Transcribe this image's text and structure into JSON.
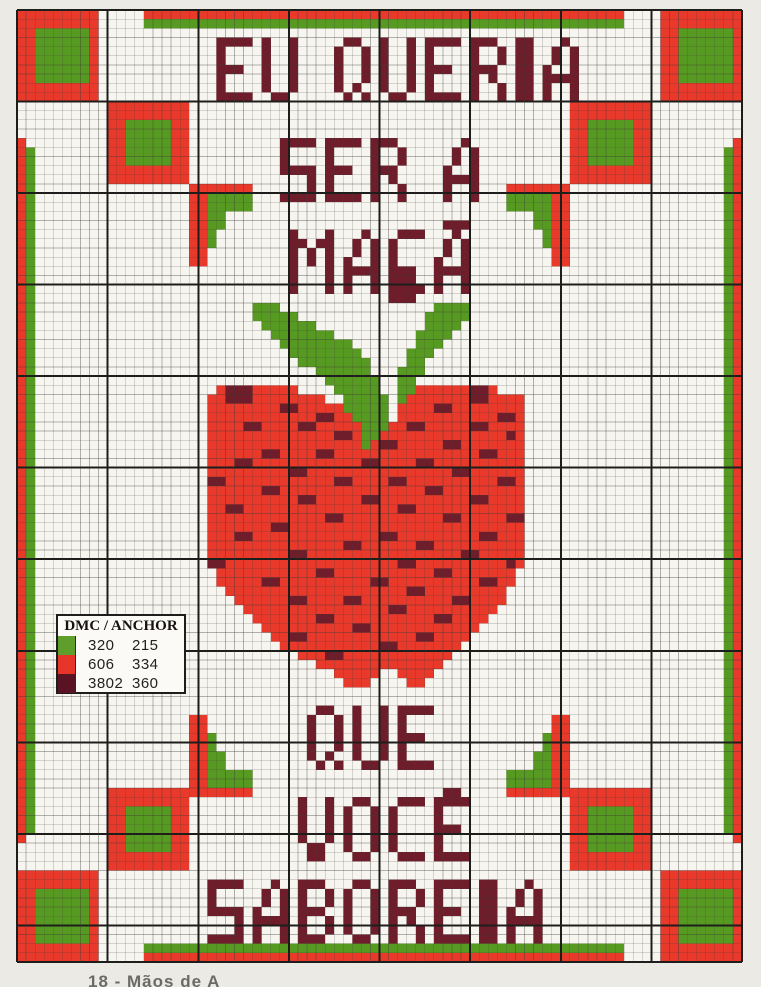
{
  "title": "Cross-stitch chart",
  "caption": {
    "text": "18 - Mãos de A"
  },
  "colors": {
    "red": "#e8392b",
    "green": "#579a21",
    "dark": "#701d2b",
    "chip_green": "#5f9e2a",
    "chip_red": "#e73529",
    "chip_dark": "#5a1322",
    "paper": "#f7f5f0",
    "page_bg": "#eceae4",
    "grid_thin": "#3a3a38",
    "grid_thick": "#1d1d1b"
  },
  "grid": {
    "cols": 80,
    "rows": 104,
    "origin_x": 17,
    "origin_y": 10,
    "width_px": 725,
    "height_px": 952
  },
  "border": {
    "rects": [
      {
        "c": 0,
        "r": 0,
        "w": 9,
        "h": 10,
        "k": "red"
      },
      {
        "c": 2,
        "r": 2,
        "w": 6,
        "h": 6,
        "k": "green"
      },
      {
        "c": 71,
        "r": 0,
        "w": 9,
        "h": 10,
        "k": "red"
      },
      {
        "c": 73,
        "r": 2,
        "w": 6,
        "h": 6,
        "k": "green"
      },
      {
        "c": 14,
        "r": 0,
        "w": 53,
        "h": 1,
        "k": "red"
      },
      {
        "c": 14,
        "r": 1,
        "w": 53,
        "h": 1,
        "k": "green"
      },
      {
        "c": 10,
        "r": 10,
        "w": 9,
        "h": 9,
        "k": "red"
      },
      {
        "c": 12,
        "r": 12,
        "w": 5,
        "h": 5,
        "k": "green"
      },
      {
        "c": 61,
        "r": 10,
        "w": 9,
        "h": 9,
        "k": "red"
      },
      {
        "c": 63,
        "r": 12,
        "w": 5,
        "h": 5,
        "k": "green"
      },
      {
        "c": 0,
        "r": 14,
        "w": 1,
        "h": 77,
        "k": "red"
      },
      {
        "c": 1,
        "r": 15,
        "w": 1,
        "h": 75,
        "k": "green"
      },
      {
        "c": 79,
        "r": 14,
        "w": 1,
        "h": 77,
        "k": "red"
      },
      {
        "c": 78,
        "r": 15,
        "w": 1,
        "h": 75,
        "k": "green"
      },
      {
        "c": 10,
        "r": 85,
        "w": 9,
        "h": 9,
        "k": "red"
      },
      {
        "c": 12,
        "r": 87,
        "w": 5,
        "h": 5,
        "k": "green"
      },
      {
        "c": 61,
        "r": 85,
        "w": 9,
        "h": 9,
        "k": "red"
      },
      {
        "c": 63,
        "r": 87,
        "w": 5,
        "h": 5,
        "k": "green"
      },
      {
        "c": 0,
        "r": 94,
        "w": 9,
        "h": 10,
        "k": "red"
      },
      {
        "c": 2,
        "r": 96,
        "w": 6,
        "h": 6,
        "k": "green"
      },
      {
        "c": 71,
        "r": 94,
        "w": 9,
        "h": 10,
        "k": "red"
      },
      {
        "c": 73,
        "r": 96,
        "w": 6,
        "h": 6,
        "k": "green"
      },
      {
        "c": 14,
        "r": 102,
        "w": 53,
        "h": 1,
        "k": "green"
      },
      {
        "c": 14,
        "r": 103,
        "w": 53,
        "h": 1,
        "k": "red"
      }
    ]
  },
  "bracket_motif": {
    "pattern": [
      ".....RR",
      ".....RR",
      "....GRR",
      "....GRR",
      "...GGRR",
      "...GGRR",
      "GGGGGRR",
      "GGGGGRR",
      "RRRRRRR"
    ],
    "placements": [
      {
        "c": 19,
        "r": 19,
        "flip": "hv"
      },
      {
        "c": 54,
        "r": 19,
        "flip": "v"
      },
      {
        "c": 19,
        "r": 77,
        "flip": "h"
      },
      {
        "c": 54,
        "r": 77,
        "flip": "none"
      }
    ]
  },
  "apple": {
    "c": 20,
    "r": 28,
    "rows": [
      "......................DD.............",
      "......................DD.............",
      ".....................DD..............",
      ".....................DD..............",
      "......GGG.................GGGG.......",
      "......GGGGG..............GGGGG.......",
      ".......GGGGGG............GGGG........",
      "........GGGGGGG.........GGGG.........",
      ".........GGGGGGGG.......GGG..........",
      "..........GGGGGGGG.....GGG...........",
      "...........GGGGGGGG....GG............",
      ".............GGGGGG...GGG............",
      "..............GGGGGG..GG.............",
      "..RDDDRRRRR....GGGGG..GGRRRRRRDDR....",
      ".RRDDDRRRRRRRR..GGGGG.GRRRRRRRDDRRRR.",
      ".RRRRRRRRDDRRRRRGGGGG.RRRRDDRRRRRRRR.",
      ".RRRRRRRRRRRRDDRRGGGG.RRRRRRRRRRRDDR.",
      ".RRRRDDRRRRDDRRRRRGGGRRDDRRRRRDDRRRR.",
      ".RRRRRRRRRRRRRRDDRGGRRRRRRRRRRRRRRDR.",
      ".RRRRRRRRRRRRRRRRRGRDDRRRRRDDRRRRRRR.",
      ".RRRRRRDDRRRRDDRRRRRRRRRRRRRRRRDDRRR.",
      ".RRRDDRRRRRRRRRRRRDDRRRRDDRRRRRRRRRR.",
      ".RRRRRRRRRDDRRRRRRRRRRRRRRRRDDRRRRRR.",
      ".DDRRRRRRRRRRRRDDRRRRDDRRRRRRRRRRDDR.",
      ".RRRRRRDDRRRRRRRRRRRRRRRRDDRRRRRRRRR.",
      ".RRRRRRRRRRDDRRRRRDDRRRRRRRRRRDDRRRR.",
      ".RRDDRRRRRRRRRRRRRRRRRDDRRRRRRRRRRRR.",
      ".RRRRRRRRRRRRRDDRRRRRRRRRRRDDRRRRRDD.",
      ".RRRRRRRDDRRRRRRRRRRRRRRRRRRRRRRRRRR.",
      ".RRRDDRRRRRRRRRRRRRRDDRRRRRRRRRDDRRR.",
      ".RRRRRRRRRRRRRRRDDRRRRRRDDRRRRRRRRRR.",
      ".RRRRRRRRRDDRRRRRRRRRRRRRRRRRDDRRRRR.",
      ".DDRRRRRRRRRRRRRRRRRRRDDRRRRRRRRRRDR.",
      "..RRRRRRRRRRRDDRRRRRRRRRRRDDRRRRRRR..",
      "..RRRRRDDRRRRRRRRRRDDRRRRRRRRRRDDRR..",
      "...RRRRRRRRRRRRRRRRRRRRDDRRRRRRRRR...",
      "....RRRRRRDDRRRRDDRRRRRRRRRRDDRRRR...",
      ".....RRRRRRRRRRRRRRRRDDRRRRRRRRRR....",
      "......RRRRRRRDDRRRRRRRRRRRDDRRRR.....",
      ".......RRRRRRRRRRDDRRRRRRRRRRRR......",
      "........RRDDRRRRRRRRRRRRDDRRRR.......",
      ".........RRRRRRRRRRRDDRRRRRRR........",
      "...........RRRDDRRRRRRRRRRRR.........",
      ".............RRRRRRRRRRRRRR..........",
      "...............RRRRR..RRRR...........",
      "................RRR....RR............"
    ]
  },
  "font": {
    "E": {
      "w": 4,
      "rise": 0,
      "rows": [
        "XXXX",
        "X...",
        "X...",
        "XXX.",
        "X...",
        "X...",
        "XXXX"
      ]
    },
    "U": {
      "w": 4,
      "rise": 0,
      "rows": [
        "X..X",
        "X..X",
        "X..X",
        "X..X",
        "X..X",
        "X..X",
        ".XX."
      ]
    },
    "Q": {
      "w": 4,
      "rise": 0,
      "rows": [
        ".XX.",
        "X..X",
        "X..X",
        "X..X",
        "X..X",
        "X.X.",
        ".X.X"
      ]
    },
    "R": {
      "w": 4,
      "rise": 0,
      "rows": [
        "XXX.",
        "X..X",
        "X..X",
        "XXX.",
        "X.X.",
        "X..X",
        "X..X"
      ]
    },
    "I": {
      "w": 2,
      "rise": 0,
      "rows": [
        "XX",
        "XX",
        "XX",
        "XX",
        "XX",
        "XX",
        "XX"
      ]
    },
    "A": {
      "w": 4,
      "rise": 0,
      "rows": [
        "..X.",
        ".X.X",
        ".X.X",
        "X..X",
        "XXXX",
        "X..X",
        "X..X"
      ]
    },
    "S": {
      "w": 4,
      "rise": 0,
      "rows": [
        "XXXX",
        "X...",
        "X...",
        "XXXX",
        "...X",
        "...X",
        "XXXX"
      ]
    },
    "B": {
      "w": 4,
      "rise": 0,
      "rows": [
        "XXX.",
        "X..X",
        "X..X",
        "XXX.",
        "X..X",
        "X..X",
        "XXX."
      ]
    },
    "M": {
      "w": 5,
      "rise": 0,
      "rows": [
        "X...X",
        "XX.XX",
        "X.X.X",
        "X.X.X",
        "X...X",
        "X...X",
        "X...X"
      ]
    },
    "O": {
      "w": 4,
      "rise": 0,
      "rows": [
        ".XX.",
        "X..X",
        "X..X",
        "X..X",
        "X..X",
        "X..X",
        ".XX."
      ]
    },
    "C": {
      "w": 4,
      "rise": 0,
      "rows": [
        ".XXX",
        "X...",
        "X...",
        "X...",
        "X...",
        "X...",
        ".XXX"
      ]
    },
    "V": {
      "w": 4,
      "rise": 0,
      "rows": [
        "X..X",
        "X..X",
        "X..X",
        "X..X",
        "X..X",
        ".XX.",
        ".XX."
      ]
    },
    "Ç": {
      "w": 4,
      "rise": 0,
      "rows": [
        ".XXX",
        "X...",
        "X...",
        "X...",
        "X...",
        "X...",
        ".XXX",
        "..X."
      ]
    },
    "Ã": {
      "w": 4,
      "rise": 1,
      "rows": [
        ".XXX",
        "..X.",
        ".X.X",
        ".X.X",
        "X..X",
        "XXXX",
        "X..X",
        "X..X"
      ]
    },
    "Ê": {
      "w": 4,
      "rise": 1,
      "rows": [
        ".XX.",
        "XXXX",
        "X...",
        "X...",
        "XXX.",
        "X...",
        "X...",
        "XXXX"
      ]
    },
    " ": {
      "w": 2,
      "rise": 0,
      "rows": []
    }
  },
  "words": [
    {
      "text": "EU QUERIA",
      "c": 22,
      "r": 3
    },
    {
      "text": "SER A",
      "c": 29,
      "r": 14
    },
    {
      "text": "MAÇÃ",
      "c": 30,
      "r": 24
    },
    {
      "text": "QUE",
      "c": 32,
      "r": 76
    },
    {
      "text": "VOCÊ",
      "c": 31,
      "r": 86
    },
    {
      "text": "SABOREIA",
      "c": 21,
      "r": 95
    }
  ],
  "legend": {
    "title": "DMC / ANCHOR",
    "rows": [
      {
        "color_key": "chip_green",
        "color_name": "green",
        "dmc": "320",
        "anchor": "215"
      },
      {
        "color_key": "chip_red",
        "color_name": "red",
        "dmc": "606",
        "anchor": "334"
      },
      {
        "color_key": "chip_dark",
        "color_name": "dark",
        "dmc": "3802",
        "anchor": "360"
      }
    ]
  }
}
